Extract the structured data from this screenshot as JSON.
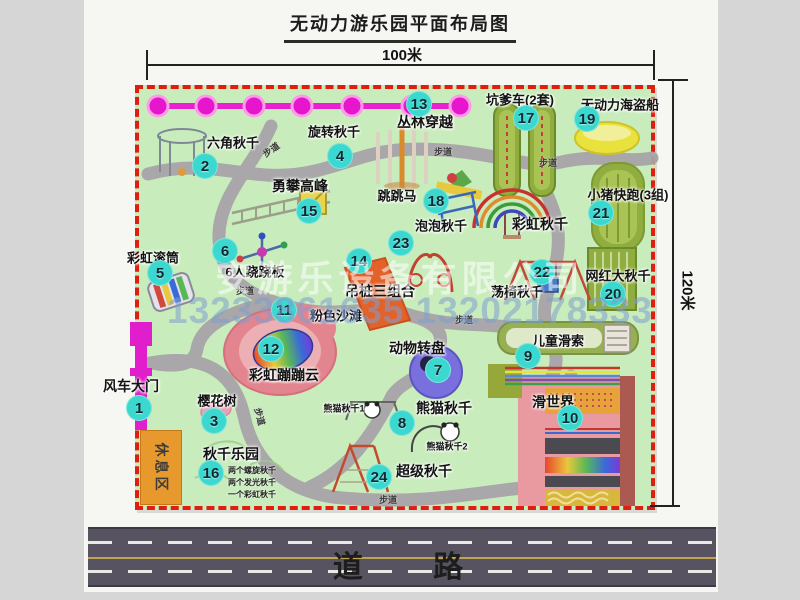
{
  "title": "无动力游乐园平面布局图",
  "dimensions": {
    "width": "100米",
    "height": "120米"
  },
  "road_label": "道 路",
  "path_label": "步道",
  "rest_area_label": "休息区",
  "watermark": {
    "company": "安游乐设备有限公司",
    "phone": "13233861635 13202178333"
  },
  "colors": {
    "map_green": "#c9ecbd",
    "border_red": "#e01e10",
    "badge_cyan": "#3bd8cf",
    "road_gray": "#575360",
    "gate_magenta": "#e01ecb",
    "chain_magenta": "#e716cc",
    "sand_pink": "#e2858e",
    "carousel_purple": "#7a70dd",
    "track_green": "#8fae3f",
    "boat_yellow": "#e9e23c",
    "rest_orange": "#e8992e"
  },
  "attractions": [
    {
      "num": "1",
      "label": "风车大门"
    },
    {
      "num": "2",
      "label": "六角秋千"
    },
    {
      "num": "3",
      "label": "樱花树"
    },
    {
      "num": "4",
      "label": "旋转秋千"
    },
    {
      "num": "5",
      "label": "彩虹滚筒"
    },
    {
      "num": "6",
      "label": "6人跷跷板"
    },
    {
      "num": "7",
      "label": "动物转盘"
    },
    {
      "num": "8",
      "label": "熊猫秋千"
    },
    {
      "num": "9",
      "label": "儿童滑索"
    },
    {
      "num": "10",
      "label": "滑世界"
    },
    {
      "num": "11",
      "label": "粉色沙滩"
    },
    {
      "num": "12",
      "label": "彩虹蹦蹦云"
    },
    {
      "num": "13",
      "label": "丛林穿越"
    },
    {
      "num": "14",
      "label": "吊桩三组合"
    },
    {
      "num": "15",
      "label": "勇攀高峰"
    },
    {
      "num": "16",
      "label": "秋千乐园"
    },
    {
      "num": "17",
      "label": "坑爹车(2套)"
    },
    {
      "num": "18",
      "label": "跳跳马"
    },
    {
      "num": "19",
      "label": "无动力海盗船"
    },
    {
      "num": "20",
      "label": "网红大秋千"
    },
    {
      "num": "21",
      "label": "小猪快跑(3组)"
    },
    {
      "num": "22",
      "label": "荡椅秋千"
    },
    {
      "num": "23",
      "label": "泡泡秋千"
    },
    {
      "num": "24",
      "label": "超级秋千"
    }
  ],
  "extra_labels": {
    "rainbow_swing": "彩虹秋千",
    "panda_swing_1": "熊猫秋千1",
    "panda_swing_2": "熊猫秋千2",
    "swing_note_1": "两个螺旋秋千",
    "swing_note_2": "两个发光秋千",
    "swing_note_3": "一个彩虹秋千"
  }
}
